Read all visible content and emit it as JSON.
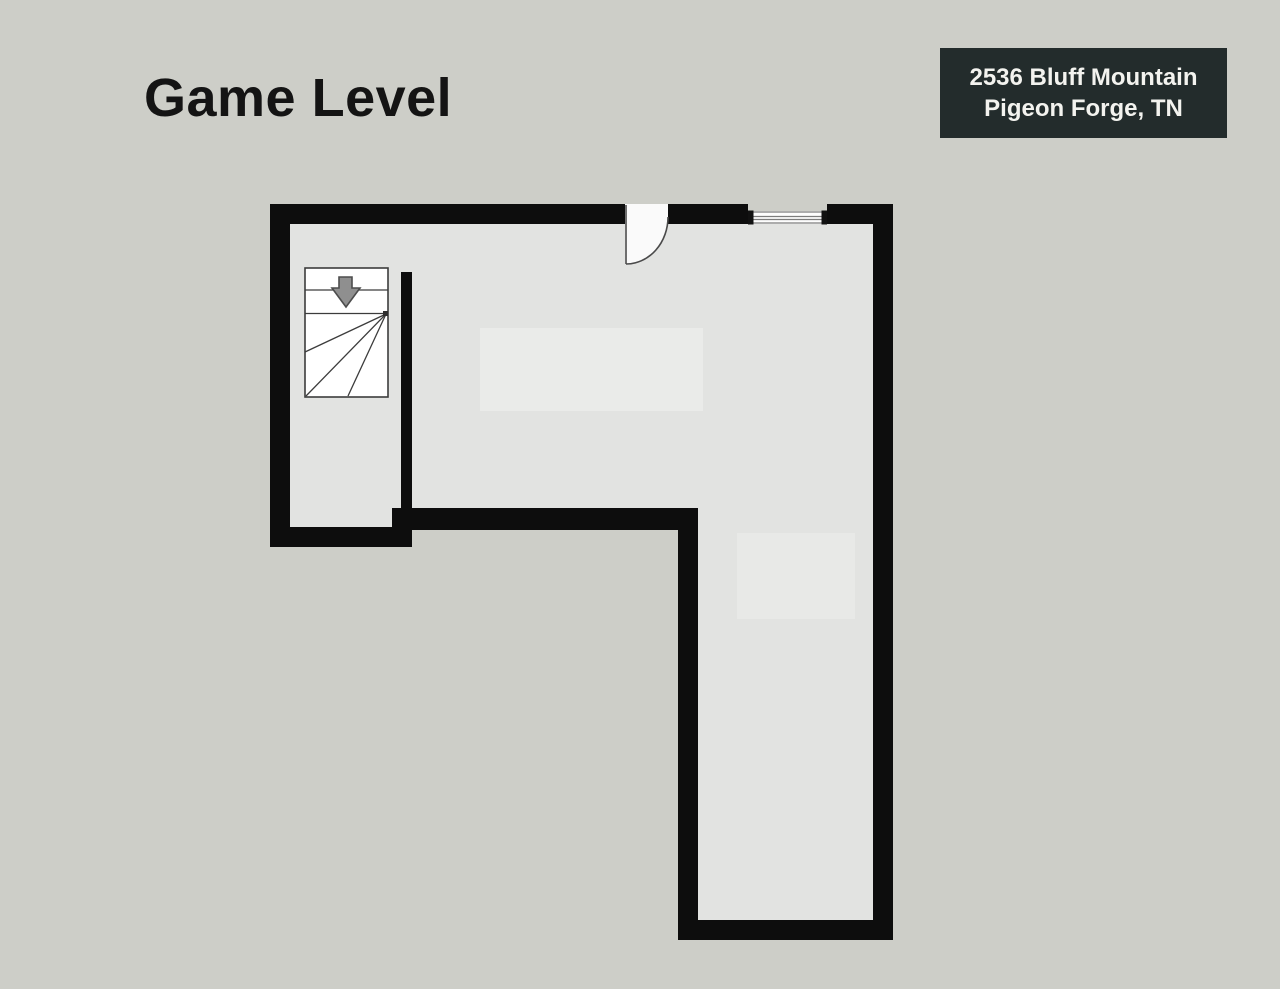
{
  "page": {
    "title": "Game Level",
    "background_color": "#cdcec8"
  },
  "address_badge": {
    "line1": "2536 Bluff Mountain",
    "line2": "Pigeon Forge, TN",
    "background_color": "#232c2c",
    "text_color": "#f3f3ef"
  },
  "floorplan": {
    "label": "Game level floor plan (L-shaped room)",
    "wall_color": "#0d0d0d",
    "floor_color": "#e2e3e1",
    "stair": {
      "icon": "stairs-down-arrow-icon",
      "arrow_fill": "#8f8f8f",
      "arrow_outline": "#4d4d4d",
      "outline_color": "#3c3c3c"
    },
    "door": {
      "icon": "door-swing-icon",
      "fill": "#fafafa",
      "stroke": "#4a4a4a"
    },
    "window": {
      "icon": "window-icon",
      "fill": "#fdfdfd",
      "stroke": "#7c7c7c"
    }
  }
}
